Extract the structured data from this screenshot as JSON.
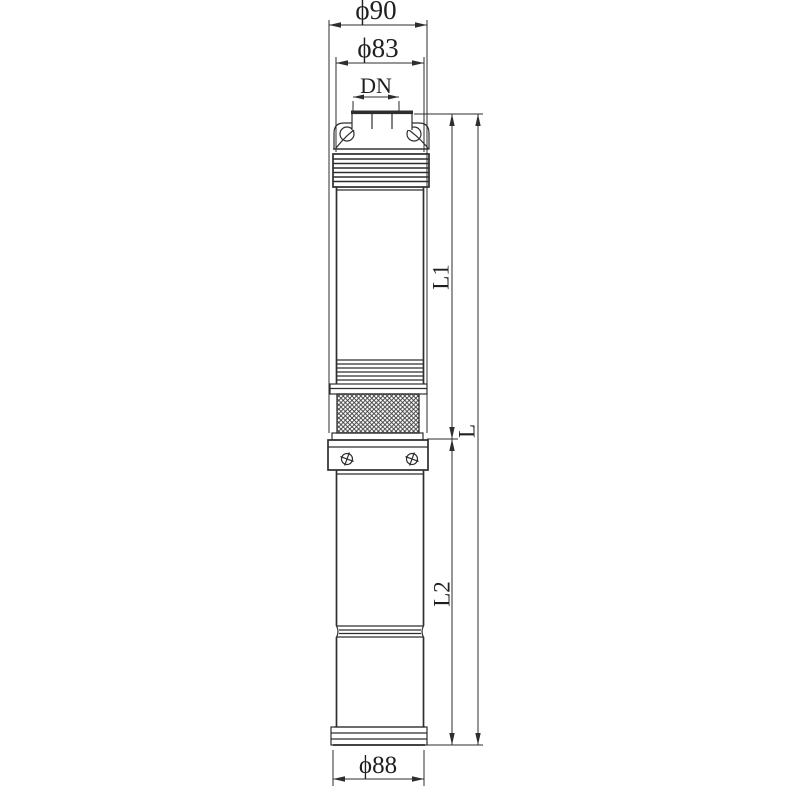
{
  "drawing": {
    "type": "technical-dimension-drawing",
    "background_color": "#ffffff",
    "line_color": "#2e2e2e",
    "labels": {
      "phi90": "ϕ90",
      "phi83": "ϕ83",
      "dn": "DN",
      "l1": "L1",
      "l": "L",
      "l2": "L2",
      "phi88": "ϕ88"
    }
  }
}
